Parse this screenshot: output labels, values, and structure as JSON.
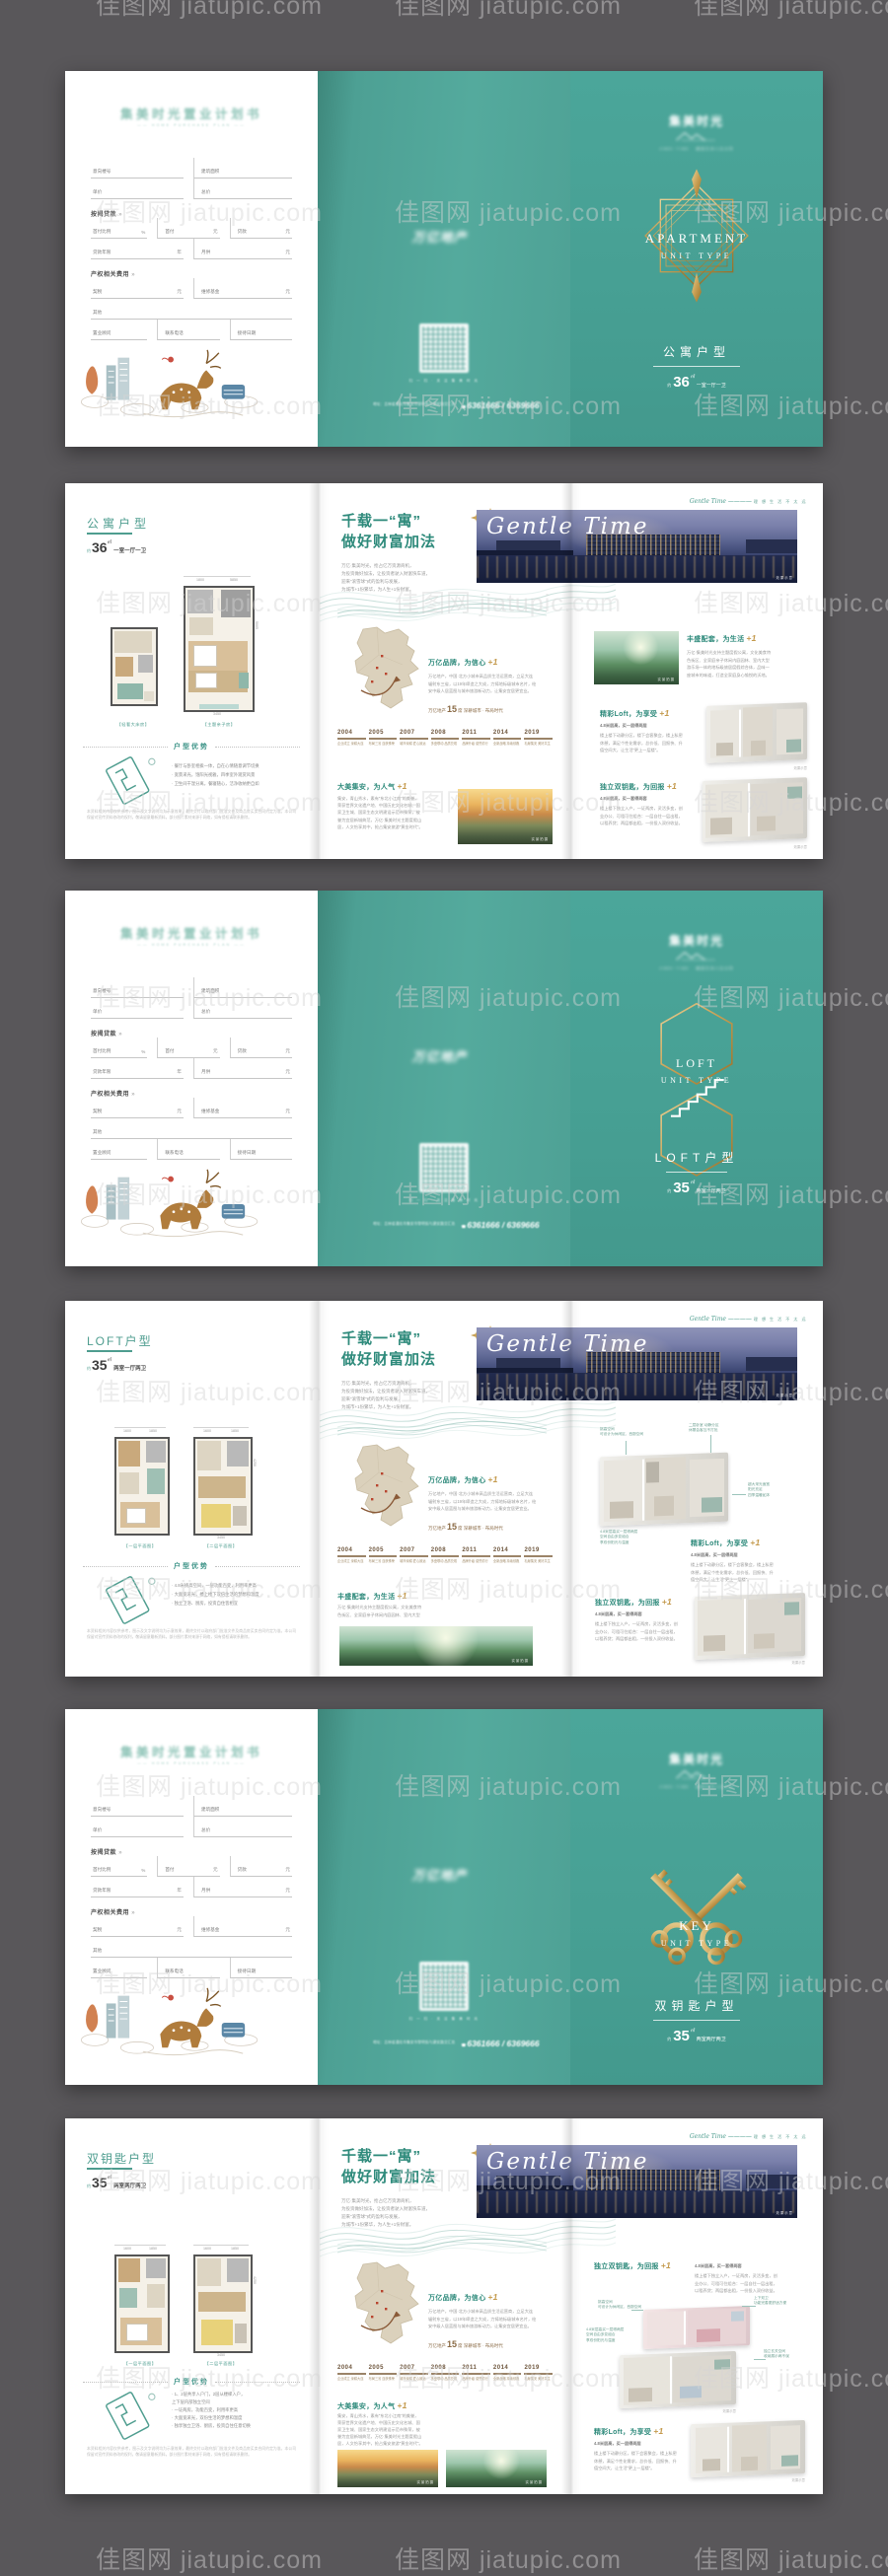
{
  "watermark": {
    "text": "佳图网 jiatupic.com"
  },
  "brand": {
    "planbook_title": "集美时光置业计划书",
    "planbook_sub": "—— HOME PURCHASE PLAN ——",
    "developer": "万亿地产",
    "qr_caption": "扫 一 扫 · 关 注 集 美 时 光",
    "address": "地址：吉林省通化市集安市黎明街与建安路交汇处",
    "phone_prefix": "☎",
    "phone": "6361666 / 6369666",
    "logo_cn": "集美时光",
    "logo_sub": "JIMEI TIME · 峰层艺术人文大宅"
  },
  "form": {
    "louhao": "意向楼号",
    "mianji": "建筑面积",
    "danjia": "单价",
    "zongjia": "总价",
    "sec1": "按揭贷款",
    "sec2": "产权相关费用",
    "arrow": "»",
    "shoufubili": "首付比例",
    "pct": "%",
    "shoufu": "首付",
    "yuan": "元",
    "daikuan": "贷款",
    "nianxian": "贷款年限",
    "nian": "年",
    "yuegong": "月供",
    "qishui": "契税",
    "weixiu": "维修基金",
    "qita": "其他",
    "guwen": "置业顾问",
    "dianhua": "联系电话",
    "riqi": "接待日期"
  },
  "covers": [
    {
      "en1": "APARTMENT",
      "en2": "UNIT TYPE",
      "cn": "公寓户型",
      "about": "约",
      "area": "36",
      "unit": "㎡",
      "rooms": "一室一厅一卫"
    },
    {
      "en1": "LOFT",
      "en2": "UNIT TYPE",
      "cn": "LOFT户型",
      "about": "约",
      "area": "35",
      "unit": "㎡",
      "rooms": "两室一厅两卫"
    },
    {
      "en1": "KEY",
      "en2": "UNIT TYPE",
      "cn": "双钥匙户型",
      "about": "约",
      "area": "35",
      "unit": "㎡",
      "rooms": "两室两厅两卫"
    }
  ],
  "plans": [
    {
      "title": "公寓户型",
      "about": "约",
      "area": "36",
      "unit": "㎡",
      "rooms": "一室一厅一卫",
      "cap1": "【轻奢大床房】",
      "cap2": "【主题亲子房】",
      "dt1": "1800",
      "dt2": "5850",
      "db": "3450",
      "dr": "5005"
    },
    {
      "title": "LOFT户型",
      "about": "约",
      "area": "35",
      "unit": "㎡",
      "rooms": "两室一厅两卫",
      "cap1": "【一层平面图】",
      "cap2": "【二层平面图】",
      "dt1": "1600",
      "dt2": "1850",
      "db": "3450",
      "dr": "4250"
    },
    {
      "title": "双钥匙户型",
      "about": "约",
      "area": "35",
      "unit": "㎡",
      "rooms": "两室两厅两卫",
      "cap1": "【一层平面图】",
      "cap2": "【二层平面图】",
      "dt1": "1600",
      "dt2": "1850",
      "db": "3450",
      "dr": "4250"
    }
  ],
  "adv": {
    "title": "户型优势",
    "b_apt": [
      "· 餐厅与卧室相挨一体，自在心情随意调节切换",
      "· 宽景采光，饱阳光视雅，四季室外观赏风景",
      "· 卫生间干湿分离，餐寝随心，洁净收纳更自如"
    ],
    "b_loft": [
      "· 4.8米挑高空间，一层功能百变，利用率更高",
      "· 大面宽采光，楼上楼下双倍生活的梦想和温度",
      "· 独立卫浴、厨房，投资自住皆相宜"
    ],
    "b_key": [
      "· 1、2层共享入户门，2层从楼梯入户，",
      "  上下层内部独立空间",
      "· 一证两房，功能百变，利用率更高",
      "· 大面宽采光，双份生活的梦想和温度",
      "· 独享独立卫浴、厨房，投资自住任意切换"
    ],
    "disc": "本资料相关内容仅供参考，图示及文字说明均为示意效果，最终交付以政府部门批准文件及商品房买卖合同约定为准。本公司保留对宣传资料修改的权利，敬请留意最新资料。部分图片素材来源于网络，如有侵权请联系删除。"
  },
  "content": {
    "h1": "千载一“寓”",
    "h2": "做好财富加法",
    "intro": [
      "万亿·集美时光，抢占亿万资源商机，",
      "为投资做好加法，让投资者驶入财富快车道，",
      "迎来“滚雪球”式的盈利与发展，",
      "为城市+1份繁华，为人生+1份财富。"
    ],
    "gt_script": "Gentle Time",
    "gt_cap_en": "Gentle Time",
    "gt_cap_dash": "————",
    "gt_cap_cn": "理 想 生 活 不 太 远",
    "photo_caps": {
      "real": "实景拍摄",
      "effect": "效果示意"
    },
    "stat": {
      "a": "万亿地产",
      "n": "15",
      "c": "席  深耕城市 · 布局时代"
    },
    "sec": {
      "brand": {
        "t": "万亿品牌，为信心",
        "p": "+1",
        "lines": [
          "万亿地产，中国·北方小城市高品质生活运营商，立足大连",
          "辐射东三省，以19年缔造之大成，力铸地标级城市名片，绘",
          "安中级人居蓝图与城市旅游新动力，让集安宜居更宜业。"
        ]
      },
      "city": {
        "t": "大美集安，为人气",
        "p": "+1",
        "lines": [
          "集安，青山秀水，素有“东北小江南”的美誉，",
          "荣获世界文化遗产地、中国历史文化名城、国",
          "家卫生城、国家生态文明建设示范市殊荣，被",
          "誉为宜居新城典范，万亿·集美时光主题度假山",
          "居，人文怡享其中，抢占集安旅游“黄金时代”。"
        ]
      },
      "amen": {
        "t": "丰盛配套，为生活",
        "p": "+1",
        "lines": [
          "万亿·集美时光支持主题度假公寓，文化美食特",
          "色街区、全家庭亲子休闲内庭园林、室内大型",
          "游乐场一体的地标级旅居度假综合体，品味一",
          "座城市的味道，打造全家庭身心愉悦的沃地。"
        ]
      },
      "loft": {
        "t": "精彩Loft，为享受",
        "p": "+1",
        "sub": "4.8米层高，买一层得两层",
        "lines": [
          "楼上楼下动静分区，楼下会客聚会，楼上私密",
          "休憩，满足个性化需求，总价低、回报快、升",
          "值空间大，让生活“更上一层楼”。"
        ]
      },
      "key": {
        "t": "独立双钥匙，为回报",
        "p": "+1",
        "sub": "4.8米层高，买一套得两套",
        "lines": [
          "楼上楼下独立入户，一证两房，灵活多变，创",
          "业办公、可租可住组合：一层自住一层出租，",
          "以租养贷；两层都出租，一份投入双份收益。"
        ]
      }
    },
    "ann": {
      "a1": "挑高空间\n可设计为休闲区、西厨空间",
      "a2": "二层卧室 动静分区\n休憩会客互不打扰",
      "a3": "超大采光面宽\n阳光充足\n四季温暖如沐",
      "a4": "4.8米层高买一层得两层\n空间自由多变组合\n享双份阳光与温度",
      "a5": "上下双卫\n功能完善更舒适方便",
      "a6": "独立玄关空间\n收纳展示两不误"
    },
    "timeline": [
      {
        "y": "2004",
        "n": "企业成立 深耕大连"
      },
      {
        "y": "2005",
        "n": "布局三省 连获殊荣"
      },
      {
        "y": "2007",
        "n": "城市深耕 匠心致远"
      },
      {
        "y": "2008",
        "n": "多盘联动 品质兑现"
      },
      {
        "y": "2011",
        "n": "品牌升级 载誉前行"
      },
      {
        "y": "2014",
        "n": "全新战略 持续领跑"
      },
      {
        "y": "2019",
        "n": "礼献集安 美好共生"
      }
    ]
  }
}
